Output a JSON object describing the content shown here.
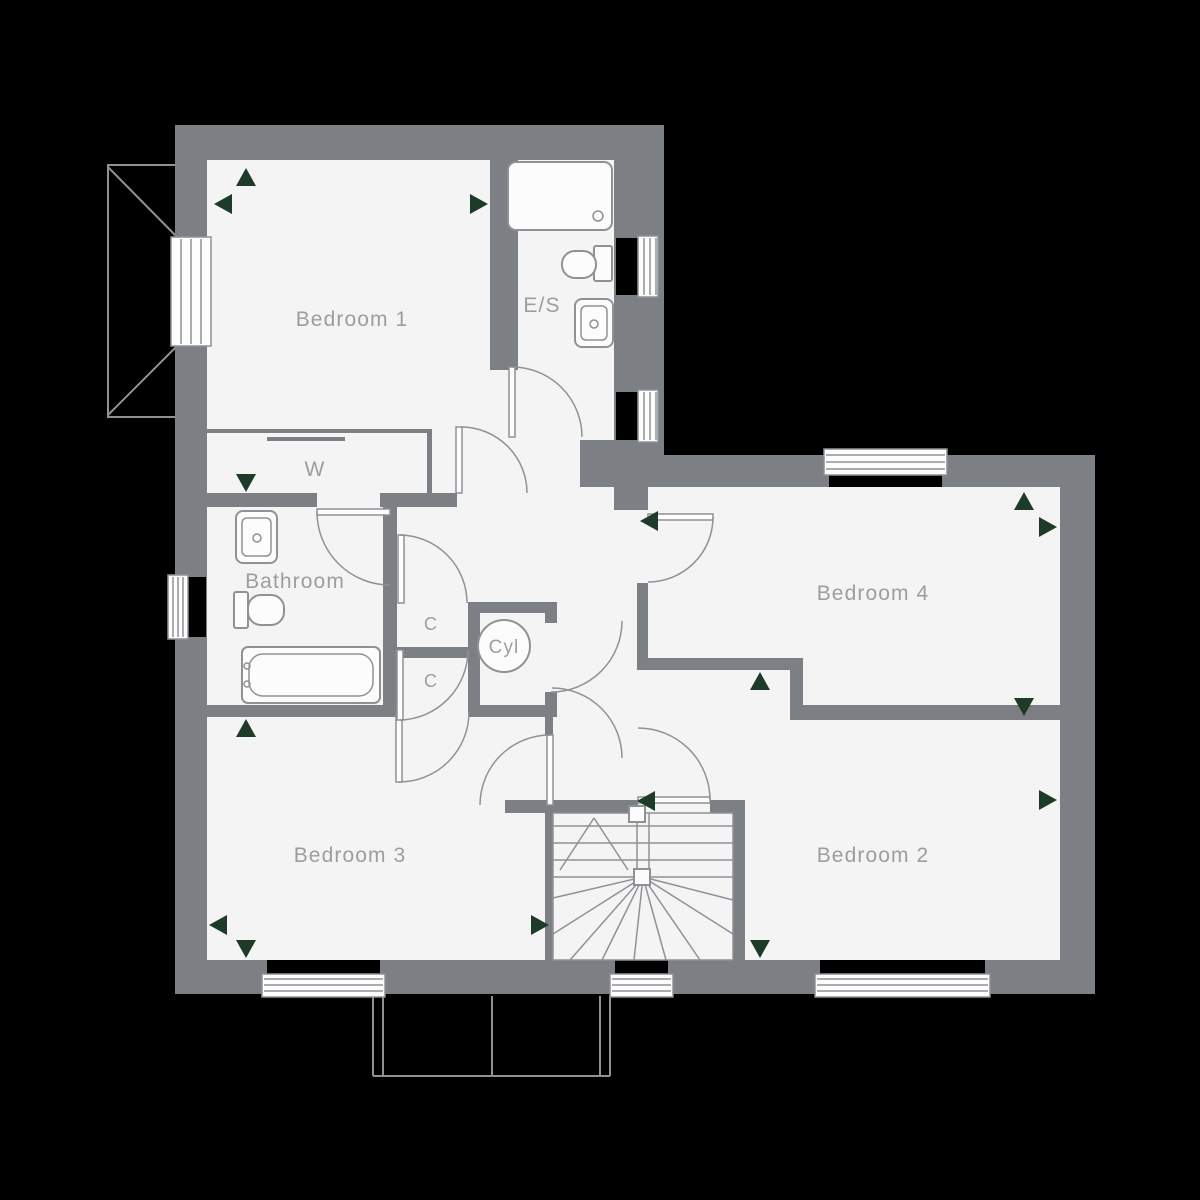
{
  "plan": {
    "title": "First floor plan",
    "colors": {
      "bg": "#000000",
      "wall": "#7c7f83",
      "floor": "#f4f4f5",
      "line": "#8f9295",
      "fixture": "#fcfcfd",
      "window": "#fdfdfe",
      "label": "#9b9ea1",
      "arrow": "#1d3b28"
    },
    "rooms": {
      "bedroom1": {
        "label": "Bedroom 1"
      },
      "ensuite": {
        "label": "E/S"
      },
      "wardrobe": {
        "label": "W"
      },
      "bathroom": {
        "label": "Bathroom"
      },
      "cupboard_upper": {
        "label": "C"
      },
      "cupboard_lower": {
        "label": "C"
      },
      "cylinder": {
        "label": "Cyl"
      },
      "bedroom4": {
        "label": "Bedroom 4"
      },
      "bedroom3": {
        "label": "Bedroom 3"
      },
      "bedroom2": {
        "label": "Bedroom 2"
      }
    }
  }
}
